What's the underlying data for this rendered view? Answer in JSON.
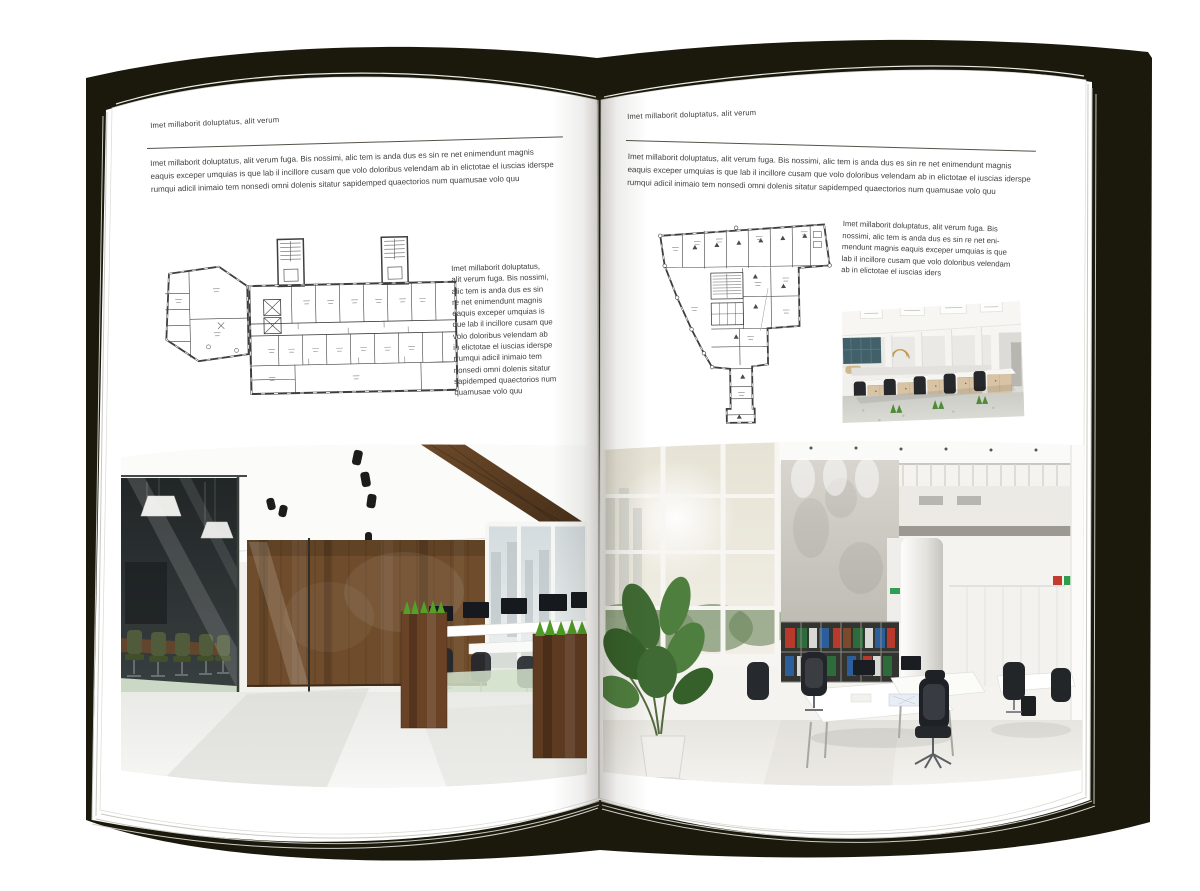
{
  "colors": {
    "backdrop": "#1b190c",
    "page": "#ffffff",
    "text": "#3d3d3d"
  },
  "spread": {
    "left_page": {
      "header": "Imet millaborit doluptatus, alit verum",
      "intro_lines": [
        "Imet millaborit doluptatus, alit verum fuga. Bis nossimi, alic tem is anda dus es sin re net enimendunt magnis",
        "eaquis exceper umquias is que lab il incillore cusam que volo doloribus velendam ab in elictotae el iuscias iderspe",
        "rumqui adicil inimaio tem nonsedi omni dolenis sitatur sapidemped quaectorios num quamusae volo quu"
      ],
      "side_lines": [
        "Imet millaborit doluptatus,",
        "alit verum fuga. Bis nossimi,",
        "alic tem is anda dus es sin",
        "re net enimendunt magnis",
        "eaquis exceper umquias is",
        "que lab il incillore cusam que",
        "volo doloribus velendam ab",
        "in elictotae el iuscias iderspe",
        "rrumqui adicil inimaio tem",
        "nonsedi omni dolenis sitatur",
        "sapidemped quaectorios num",
        "quamusae volo quu"
      ]
    },
    "right_page": {
      "header": "Imet millaborit doluptatus, alit verum",
      "intro_lines": [
        "Imet millaborit doluptatus, alit verum fuga. Bis nossimi, alic tem is anda dus es sin re net enimendunt magnis",
        "eaquis exceper umquias is que lab il incillore cusam que volo doloribus velendam ab in elictotae el iuscias iderspe",
        "rumqui adicil inimaio tem nonsedi omni dolenis sitatur sapidemped quaectorios num quamusae volo quu"
      ],
      "side_lines": [
        "Imet millaborit doluptatus, alit verum fuga. Bis",
        "nossimi, alic tem is anda dus es sin re net eni-",
        "mendunt magnis eaquis exceper umquias is que",
        "lab il incillore cusam que volo doloribus velendam",
        "ab in elictotae el iuscias iders"
      ]
    }
  }
}
